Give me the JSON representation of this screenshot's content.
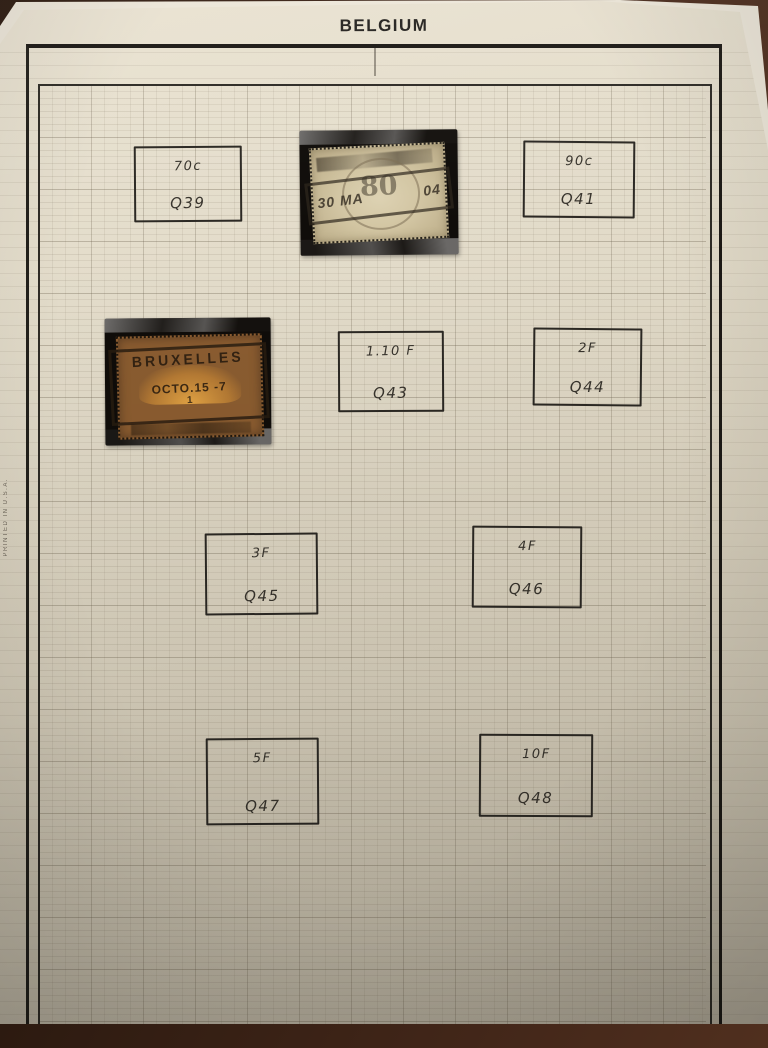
{
  "page": {
    "title": "BELGIUM",
    "side_note": "PRINTED IN U.S.A.",
    "description": "Hand-ruled stamp album quadrille page with spaces for Belgian parcel-post (railway) stamps"
  },
  "colors": {
    "photo_background": "#45281a",
    "paper": "#ddd5c3",
    "under_sheet": "#ece6d8",
    "frame_ink": "#1c1915",
    "grid_line": "#9b9181",
    "handwriting_ink": "#37332c",
    "mount_black": "#0f0c09",
    "stamp1_paper": "#d2c5a2",
    "stamp2_orange": "#d18e33",
    "stamp2_border_brown": "#6f4a2e",
    "postmark_ink": "#2d261c"
  },
  "spaces": [
    {
      "value": "70c",
      "catalog": "Q39"
    },
    {
      "value": "90c",
      "catalog": "Q41"
    },
    {
      "value": "1.10 F",
      "catalog": "Q43"
    },
    {
      "value": "2F",
      "catalog": "Q44"
    },
    {
      "value": "3F",
      "catalog": "Q45"
    },
    {
      "value": "4F",
      "catalog": "Q46"
    },
    {
      "value": "5F",
      "catalog": "Q47"
    },
    {
      "value": "10F",
      "catalog": "Q48"
    }
  ],
  "stamps": [
    {
      "name": "pale buff railway stamp in black mount",
      "center_text": "80",
      "cancel_left": "30 MA",
      "cancel_right": "04"
    },
    {
      "name": "orange 1-franc railway stamp in black mount",
      "cancel_city": "BRUXELLES",
      "cancel_date": "OCTO.15 -7",
      "cancel_number": "1"
    }
  ]
}
